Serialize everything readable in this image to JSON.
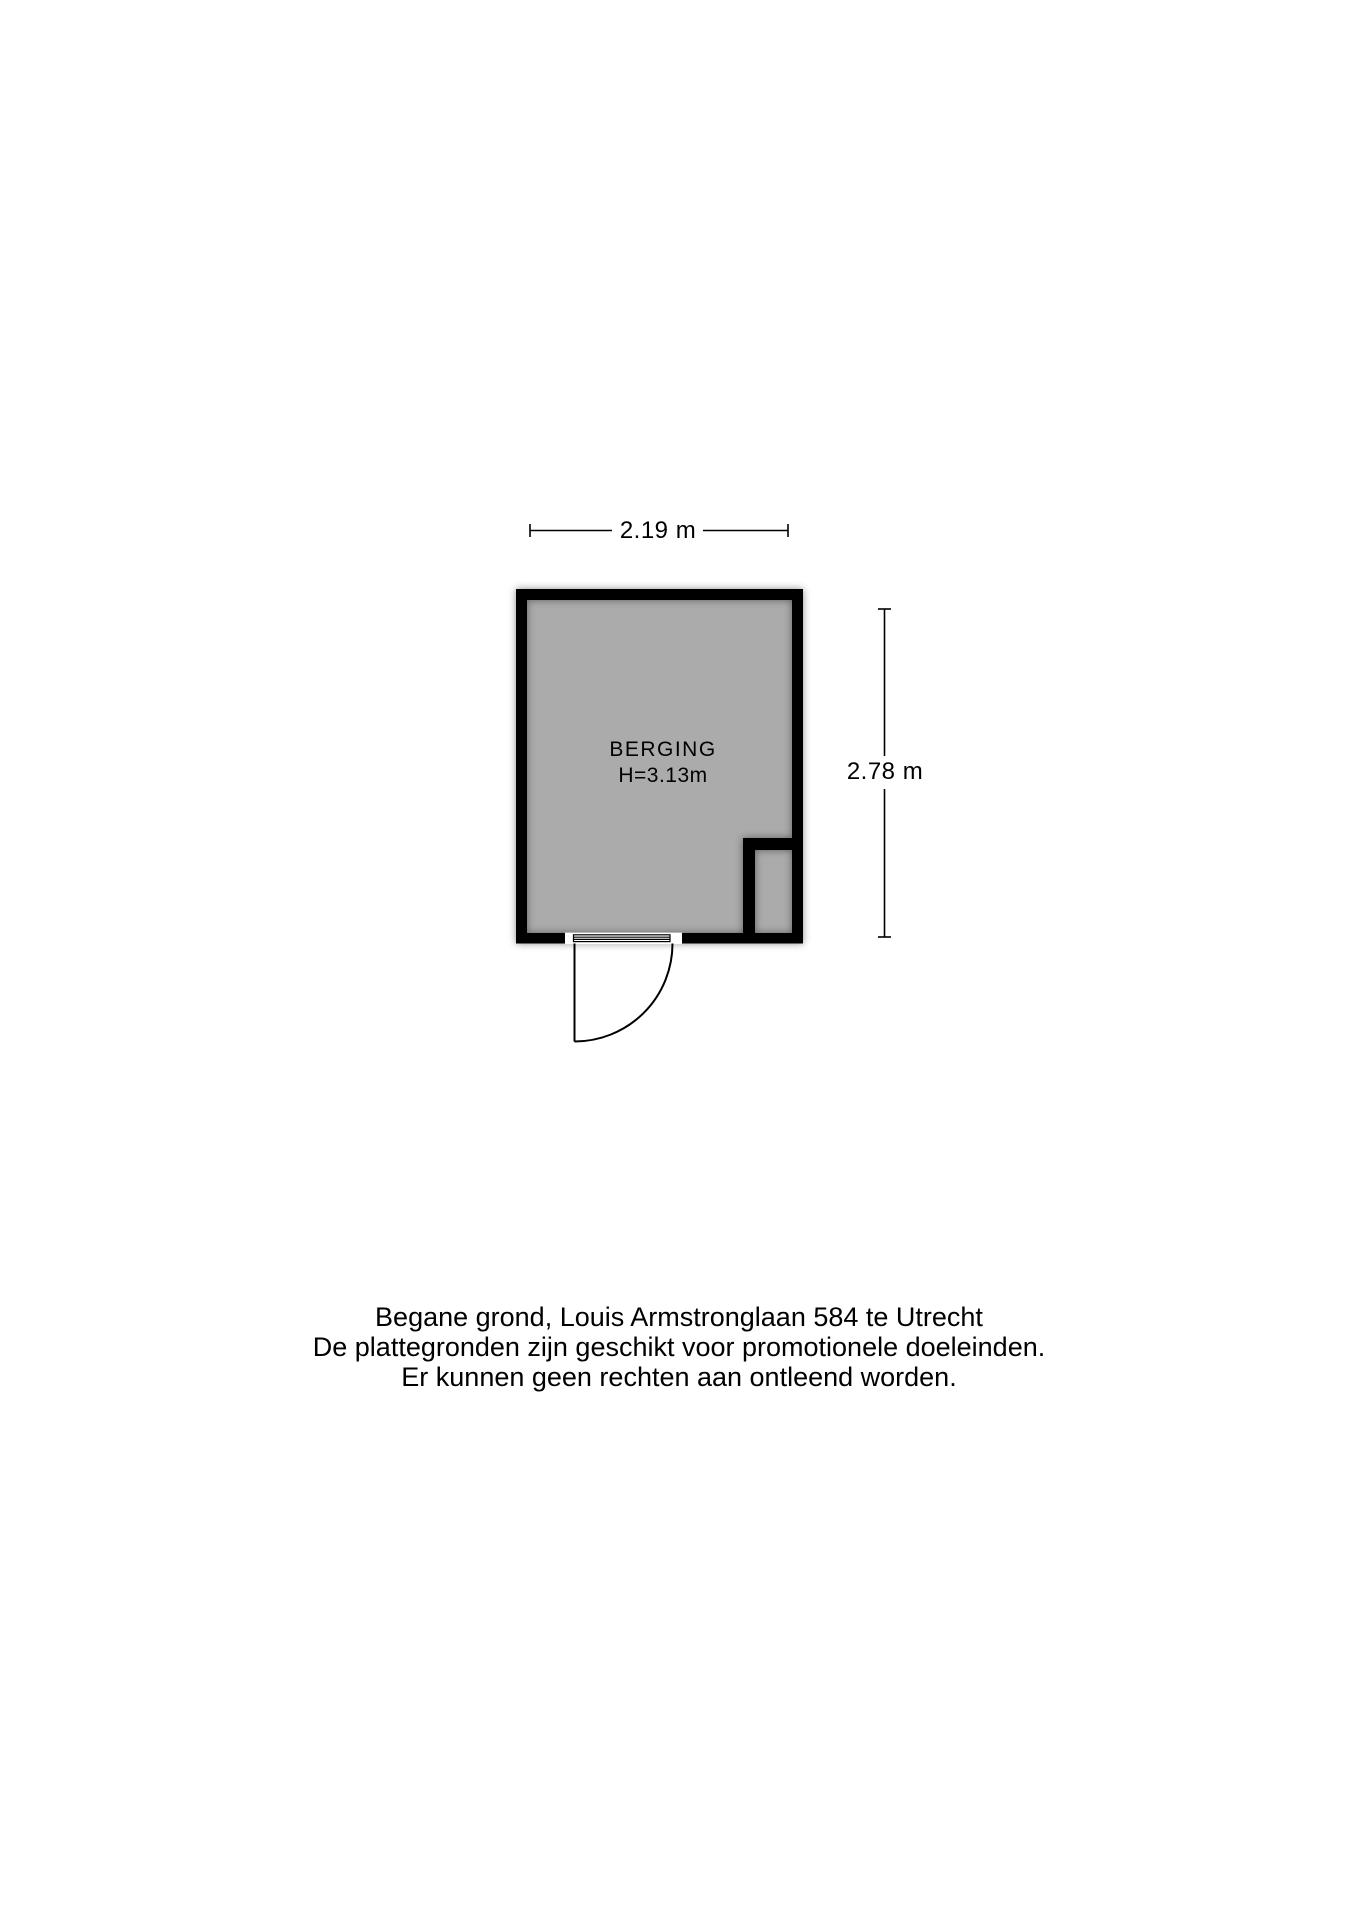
{
  "floorplan": {
    "width_label": "2.19 m",
    "height_label": "2.78 m",
    "room_name": "BERGING",
    "room_height": "H=3.13m",
    "colors": {
      "wall": "#000000",
      "floor": "#ababab",
      "line": "#000000",
      "background": "#ffffff"
    }
  },
  "footer": {
    "lines": [
      "Begane grond, Louis Armstronglaan 584 te Utrecht",
      "De plattegronden zijn geschikt voor promotionele doeleinden.",
      "Er kunnen geen rechten aan ontleend worden."
    ]
  }
}
